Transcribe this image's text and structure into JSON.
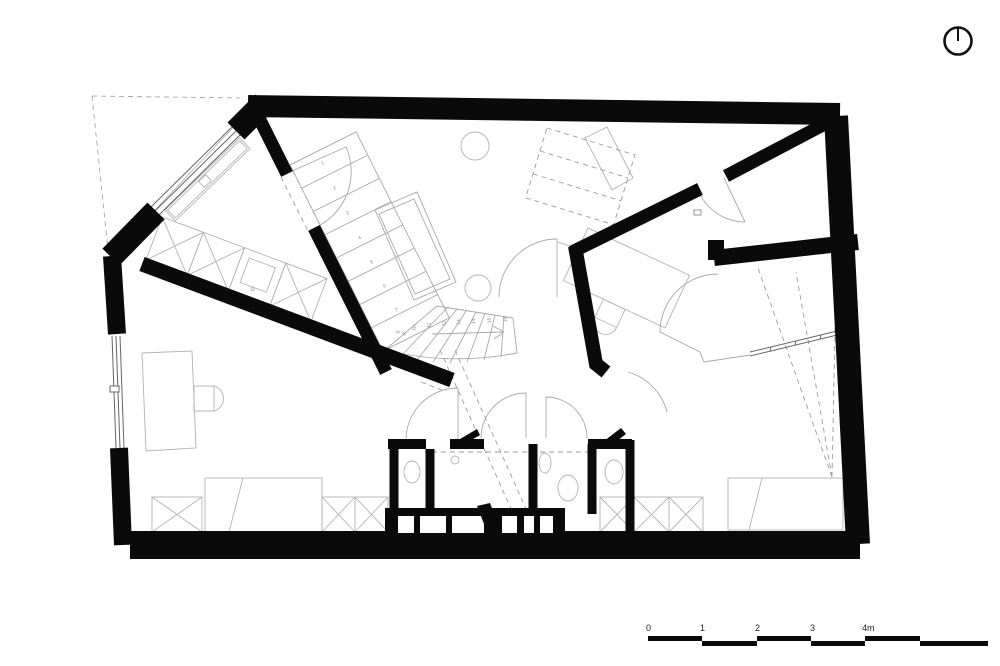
{
  "title": "Upper floor plan",
  "north_arrow": {
    "label": "north"
  },
  "scale_bar": {
    "labels": [
      "0",
      "1",
      "2",
      "3",
      "4m"
    ]
  },
  "stairs": {
    "annotation": "16 marches h=17,8 g=27,0",
    "tread_numbers": [
      "1",
      "2",
      "3",
      "4",
      "5",
      "6",
      "7",
      "8",
      "9",
      "10",
      "11",
      "12",
      "13",
      "14",
      "15",
      "16"
    ]
  },
  "colors": {
    "wall": "#0a0a0a",
    "furniture_line": "#b3b3b3",
    "dashed_line": "#9c9c9c",
    "window_line": "#666666",
    "background": "#ffffff"
  }
}
